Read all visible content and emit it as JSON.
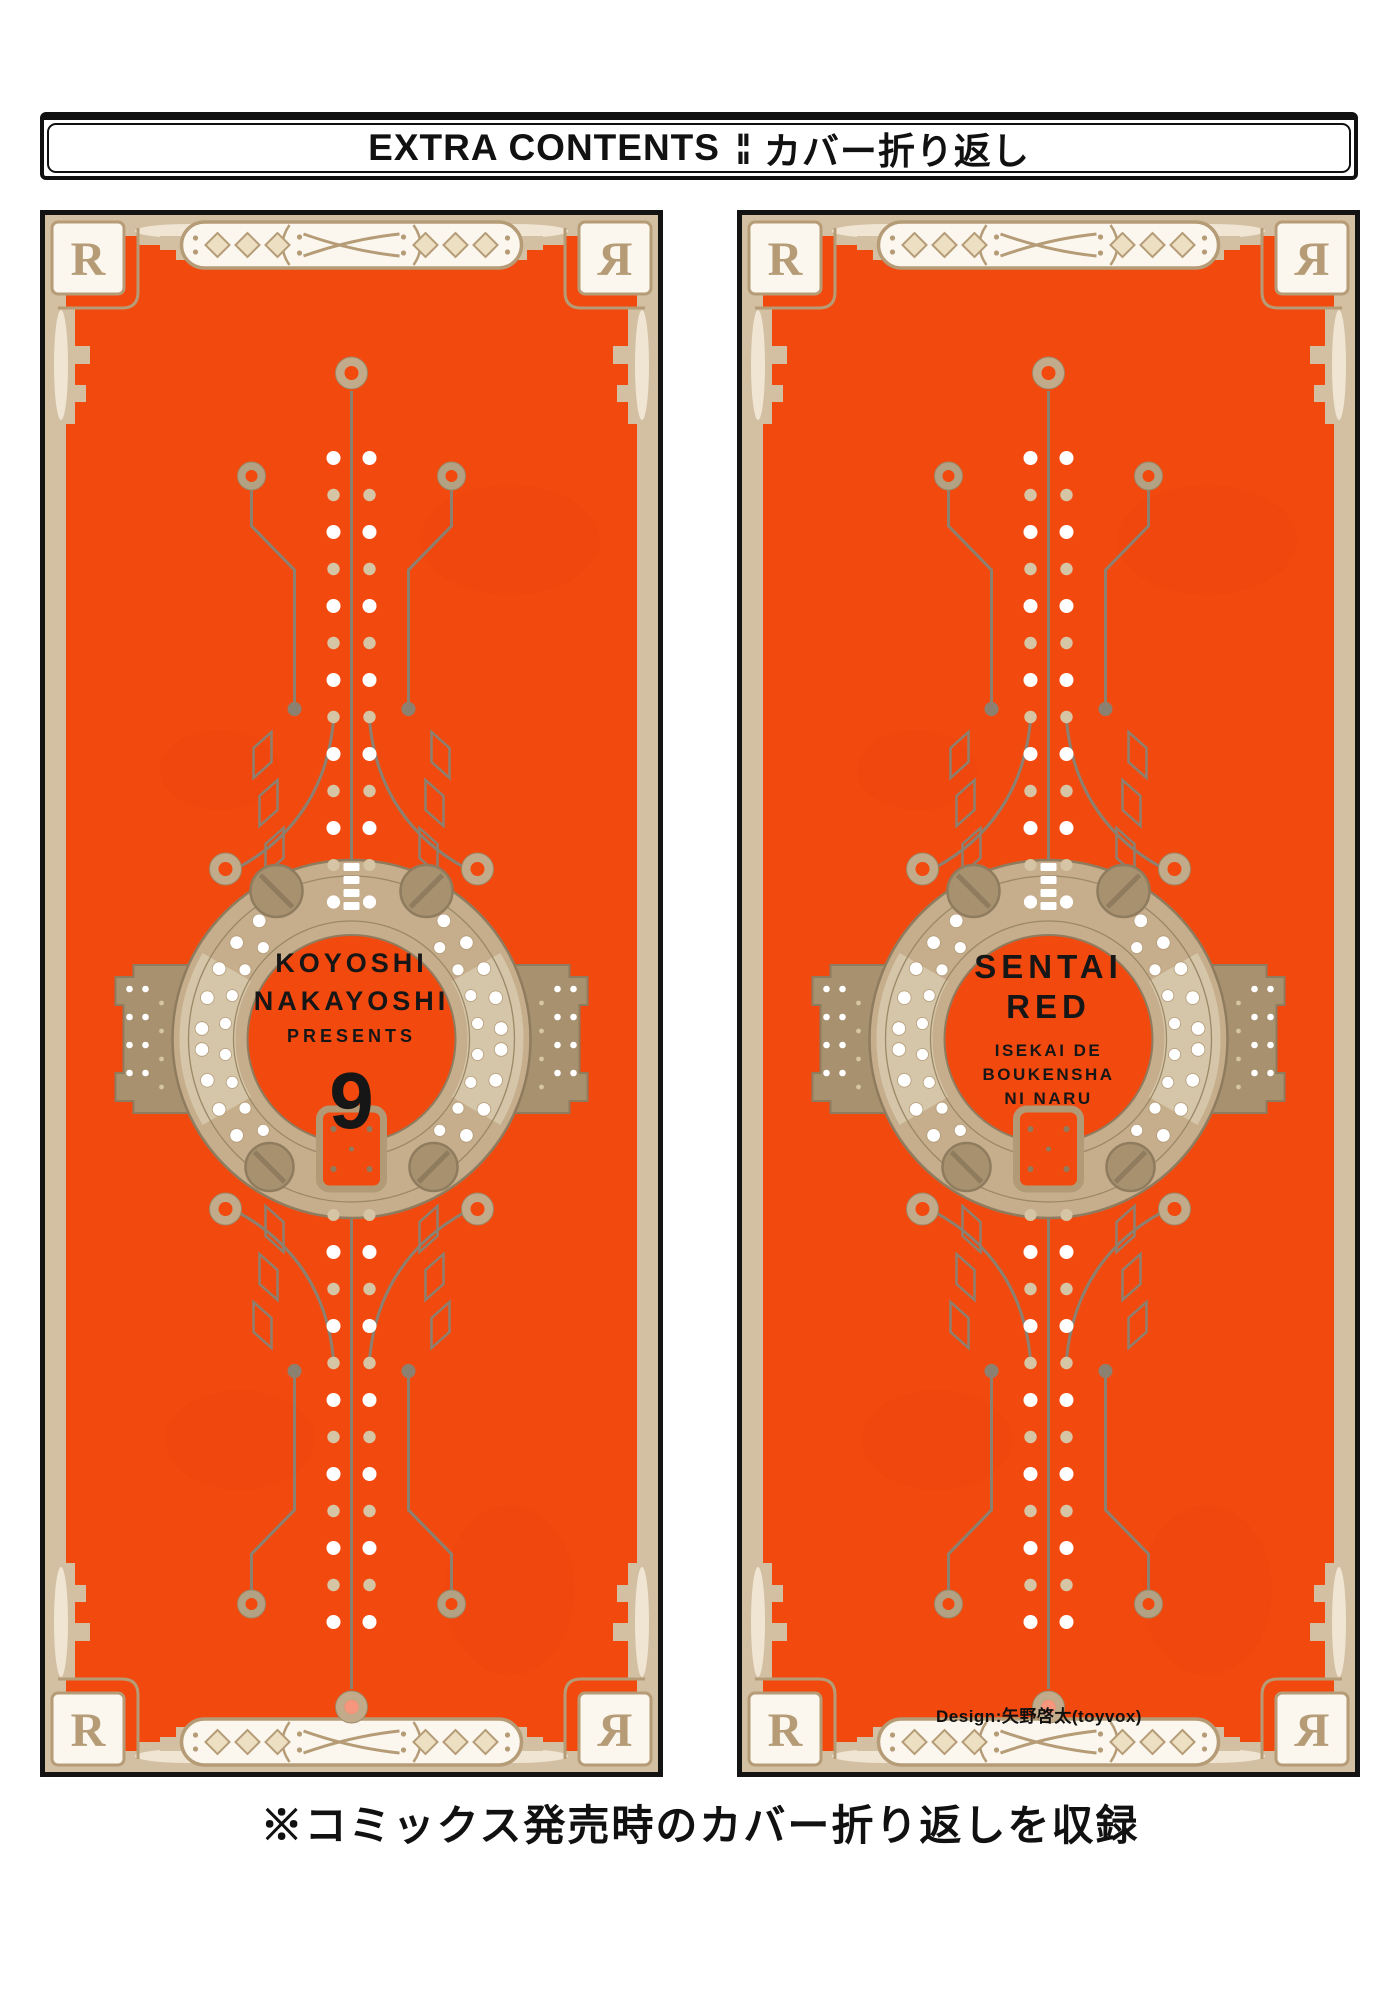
{
  "header": {
    "title_en": "EXTRA CONTENTS",
    "separator": "¦¦",
    "title_ja": "カバー折り返し"
  },
  "corner_logo": "R",
  "left_panel": {
    "line1": "KOYOSHI",
    "line2": "NAKAYOSHI",
    "line3": "PRESENTS",
    "volume": "9"
  },
  "right_panel": {
    "line1": "SENTAI",
    "line2": "RED",
    "sub1": "ISEKAI DE",
    "sub2": "BOUKENSHA",
    "sub3": "NI NARU",
    "design_credit": "Design:矢野啓太(toyvox)"
  },
  "footer": {
    "note": "※コミックス発売時のカバー折り返しを収録"
  },
  "colors": {
    "orange": "#f2490f",
    "frame_tan": "#d3c0a3",
    "accent_tan": "#b59c77",
    "ring_tan": "#c6ae8c",
    "circuit_gray": "#8c8170",
    "ink_black": "#111111"
  }
}
